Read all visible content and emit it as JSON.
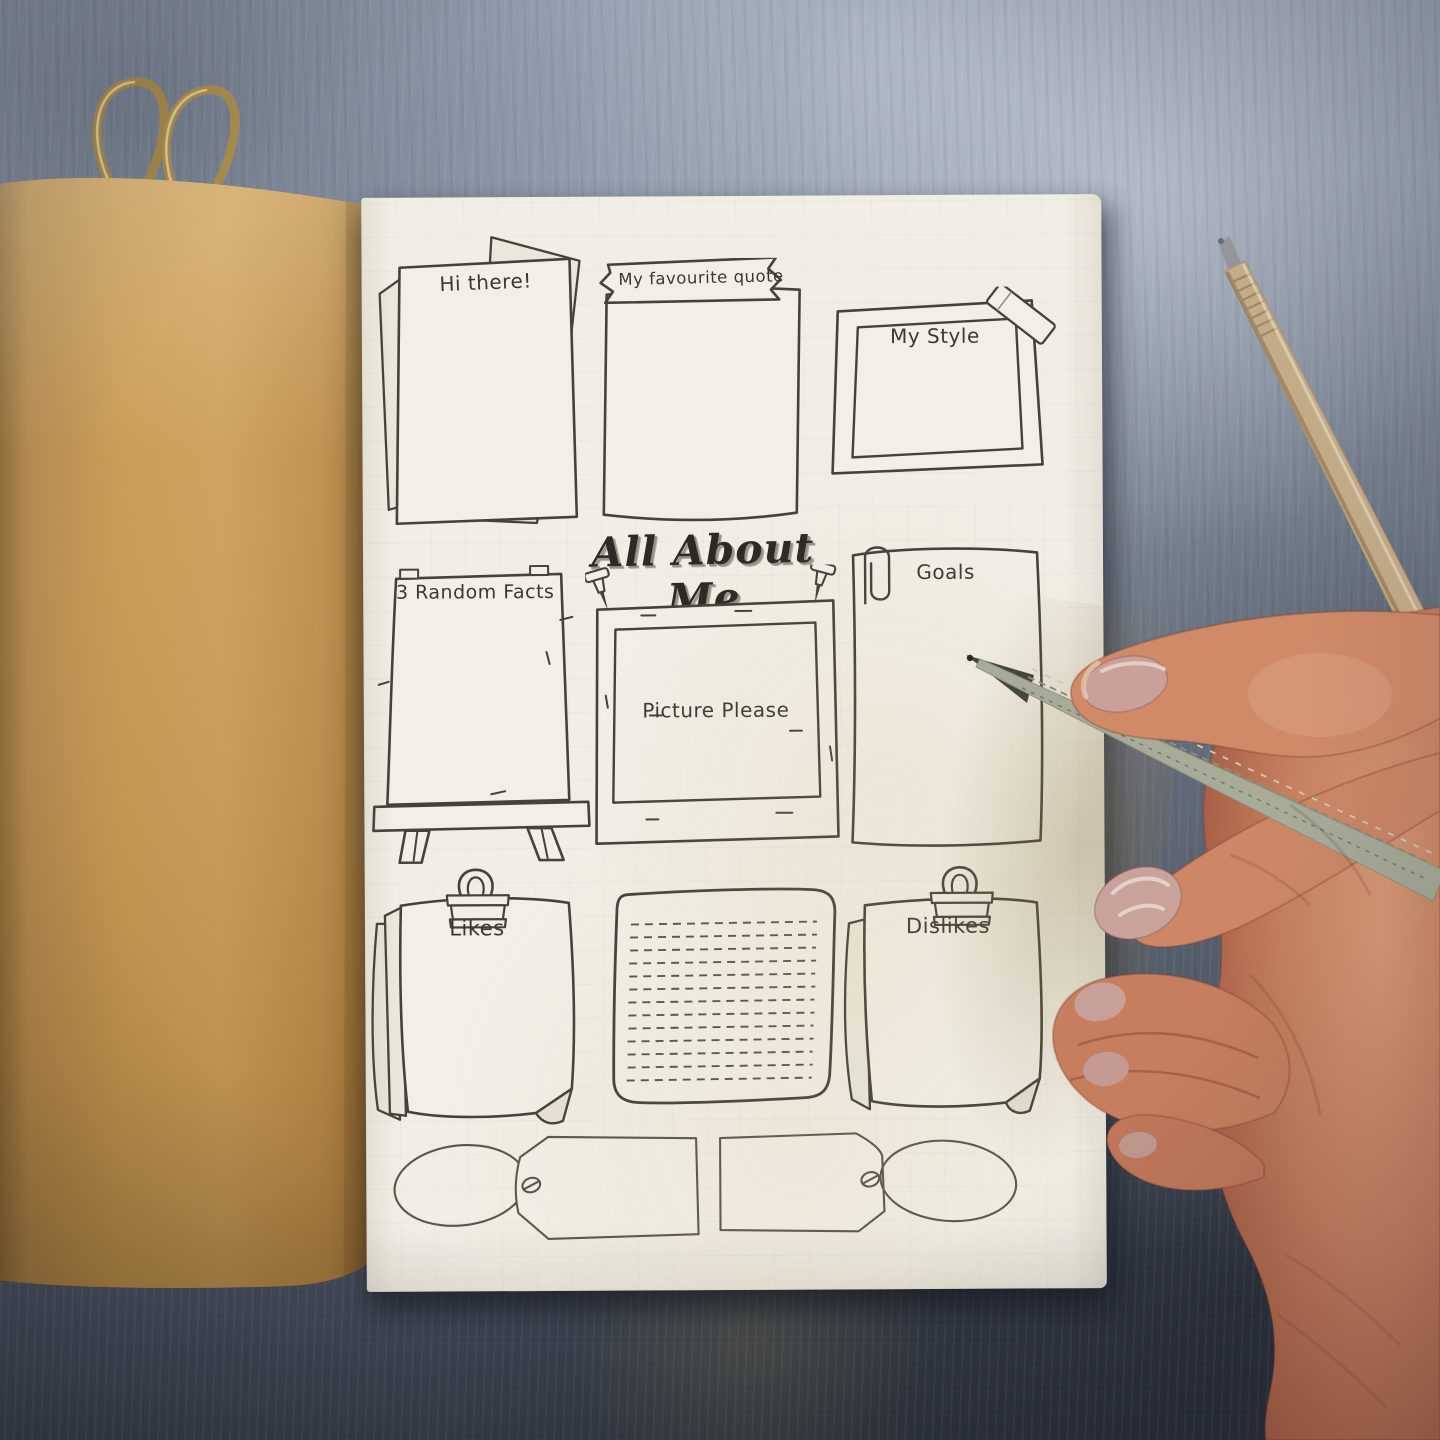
{
  "page": {
    "title": "All About Me",
    "boxes": {
      "hi_there": "Hi there!",
      "favourite_quote": "My favourite quote",
      "my_style": "My Style",
      "random_facts": "3 Random Facts",
      "picture_please": "Picture Please",
      "goals": "Goals",
      "likes": "Likes",
      "dislikes": "Dislikes"
    }
  },
  "objects": {
    "heart_clip": "brass-heart-wire-clip",
    "kraft_pen": "kraft-paper-pen",
    "journal_cover": "kraft-journal-cover",
    "hand": "hand-holding-newspaper-pencil",
    "paperclip": "paperclip",
    "push_pins": "push-pins",
    "binder_clips": "binder-clips",
    "washi_tape": "washi-tape-strip",
    "easel": "easel-board",
    "gift_tags": "blank-gift-tags",
    "lined_note": "dashed-lines-note"
  },
  "colors": {
    "ink": "#45423c",
    "paper": "#f1eee5",
    "paper_shadow": "#eae7db",
    "kraft": "#c2944f",
    "concrete_light": "#97a1b1",
    "concrete_dark": "#343a46",
    "brass": "#a88c4e",
    "skin": "#c07f5f",
    "nail": "#c9a09a",
    "pencil_wrap": "#a8ab98"
  }
}
